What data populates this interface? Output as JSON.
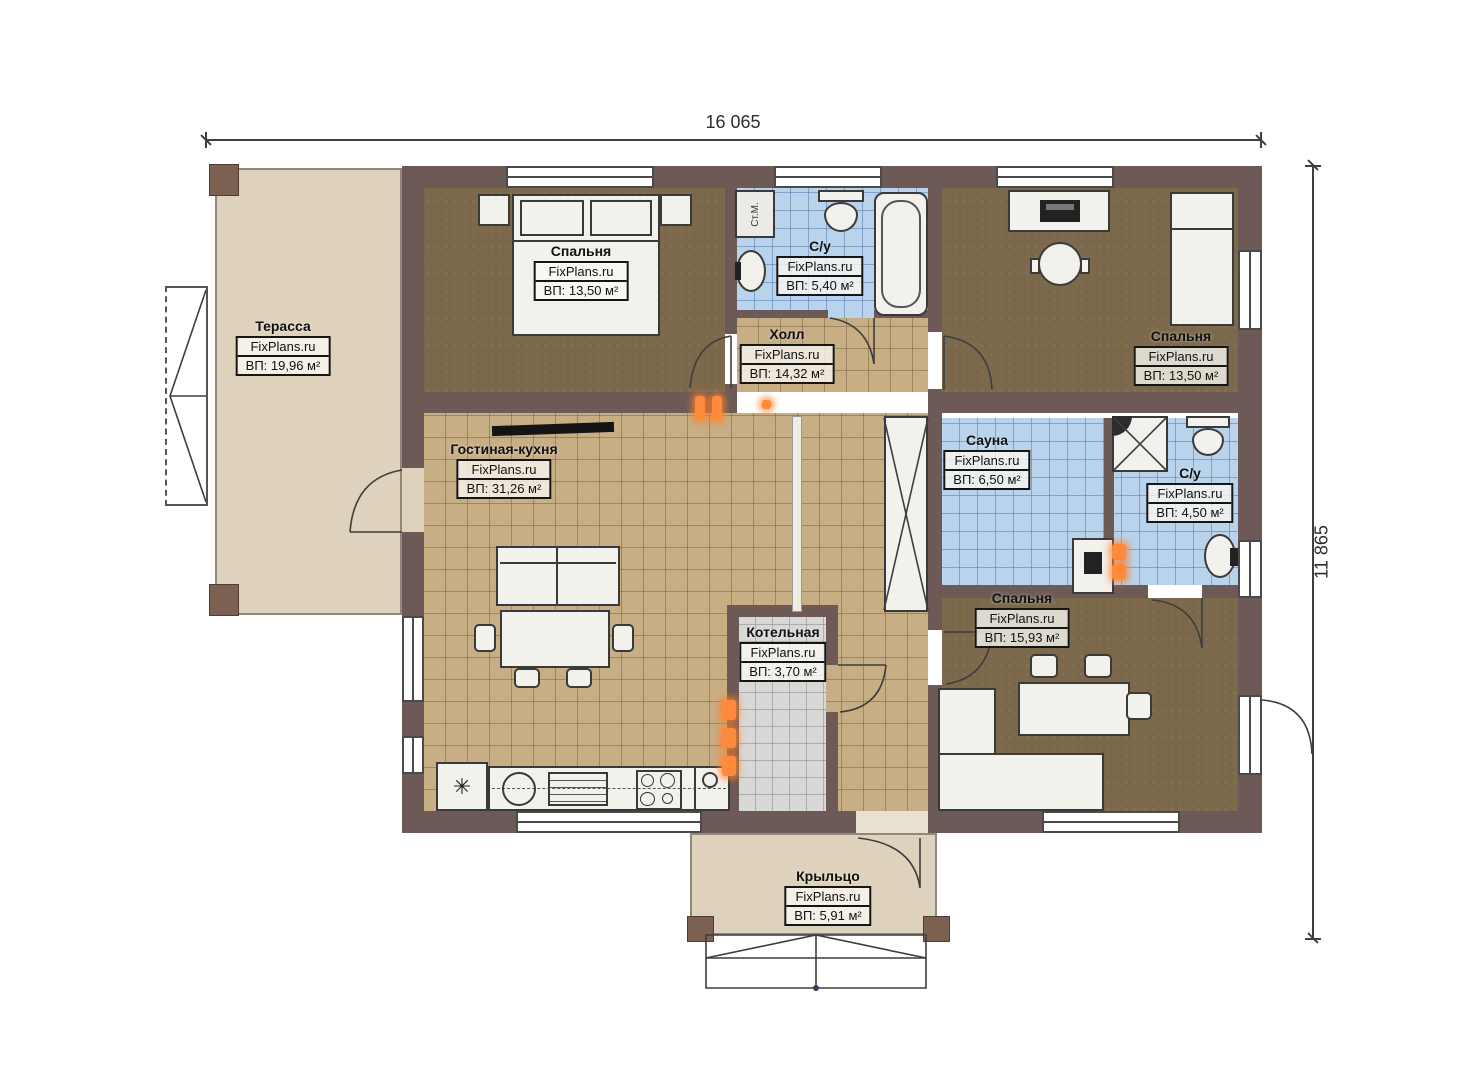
{
  "plan": {
    "dimension_width": "16 065",
    "dimension_height": "11 865"
  },
  "rooms": [
    {
      "id": "terrace",
      "name": "Терасса",
      "brand": "FixPlans.ru",
      "area": "ВП: 19,96 м²"
    },
    {
      "id": "bedroom-1",
      "name": "Спальня",
      "brand": "FixPlans.ru",
      "area": "ВП: 13,50 м²"
    },
    {
      "id": "bathroom-1",
      "name": "С/у",
      "brand": "FixPlans.ru",
      "area": "ВП: 5,40 м²"
    },
    {
      "id": "hall",
      "name": "Холл",
      "brand": "FixPlans.ru",
      "area": "ВП: 14,32 м²"
    },
    {
      "id": "bedroom-2",
      "name": "Спальня",
      "brand": "FixPlans.ru",
      "area": "ВП: 13,50 м²"
    },
    {
      "id": "living-kitchen",
      "name": "Гостиная-кухня",
      "brand": "FixPlans.ru",
      "area": "ВП: 31,26 м²"
    },
    {
      "id": "sauna",
      "name": "Сауна",
      "brand": "FixPlans.ru",
      "area": "ВП: 6,50 м²"
    },
    {
      "id": "bathroom-2",
      "name": "С/у",
      "brand": "FixPlans.ru",
      "area": "ВП: 4,50 м²"
    },
    {
      "id": "bedroom-3",
      "name": "Спальня",
      "brand": "FixPlans.ru",
      "area": "ВП: 15,93 м²"
    },
    {
      "id": "boiler",
      "name": "Котельная",
      "brand": "FixPlans.ru",
      "area": "ВП: 3,70 м²"
    },
    {
      "id": "porch",
      "name": "Крыльцо",
      "brand": "FixPlans.ru",
      "area": "ВП: 5,91 м²"
    }
  ],
  "fixtures": {
    "washing_machine_label": "Ст.М.",
    "fridge_symbol": "✳"
  },
  "colors": {
    "wall": "#6d5a57",
    "wood_floor": "#7c694c",
    "tile_floor": "#c7ae85",
    "wet_floor": "#b9d3ec",
    "boiler_floor": "#d9d8d6",
    "deck": "#ded2bc",
    "radiator": "#ff8a3c"
  }
}
